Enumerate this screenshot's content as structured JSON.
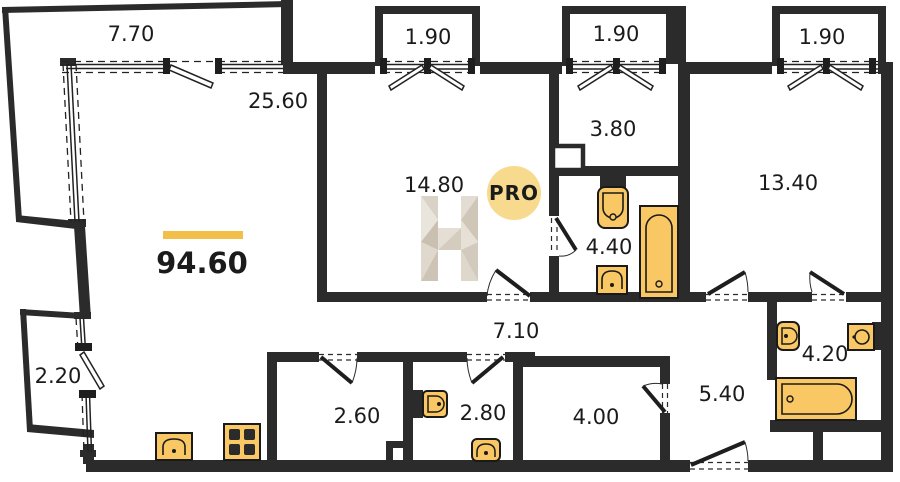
{
  "floorplan": {
    "total_area": "94.60",
    "watermark_badge": "PRO",
    "rooms": {
      "living": "25.60",
      "room_mid": "14.80",
      "hall_top": "3.80",
      "bedroom_right": "13.40",
      "bathroom_mid": "4.40",
      "corridor": "7.10",
      "storage_1": "2.60",
      "wc": "2.80",
      "storage_2": "4.00",
      "hall_right": "5.40",
      "bathroom_right": "4.20"
    },
    "balconies": {
      "top_left": "7.70",
      "top_1": "1.90",
      "top_2": "1.90",
      "top_3": "1.90",
      "bottom_left": "2.20"
    },
    "colors": {
      "wall": "#2b2b2b",
      "fixture_fill": "#f9c763",
      "accent_bar": "#f2c04a",
      "badge_fill": "#f8da8e",
      "badge_text": "#bbae97",
      "watermark_light": "#e9e4dc",
      "watermark_dark": "#c9c0b1"
    }
  }
}
